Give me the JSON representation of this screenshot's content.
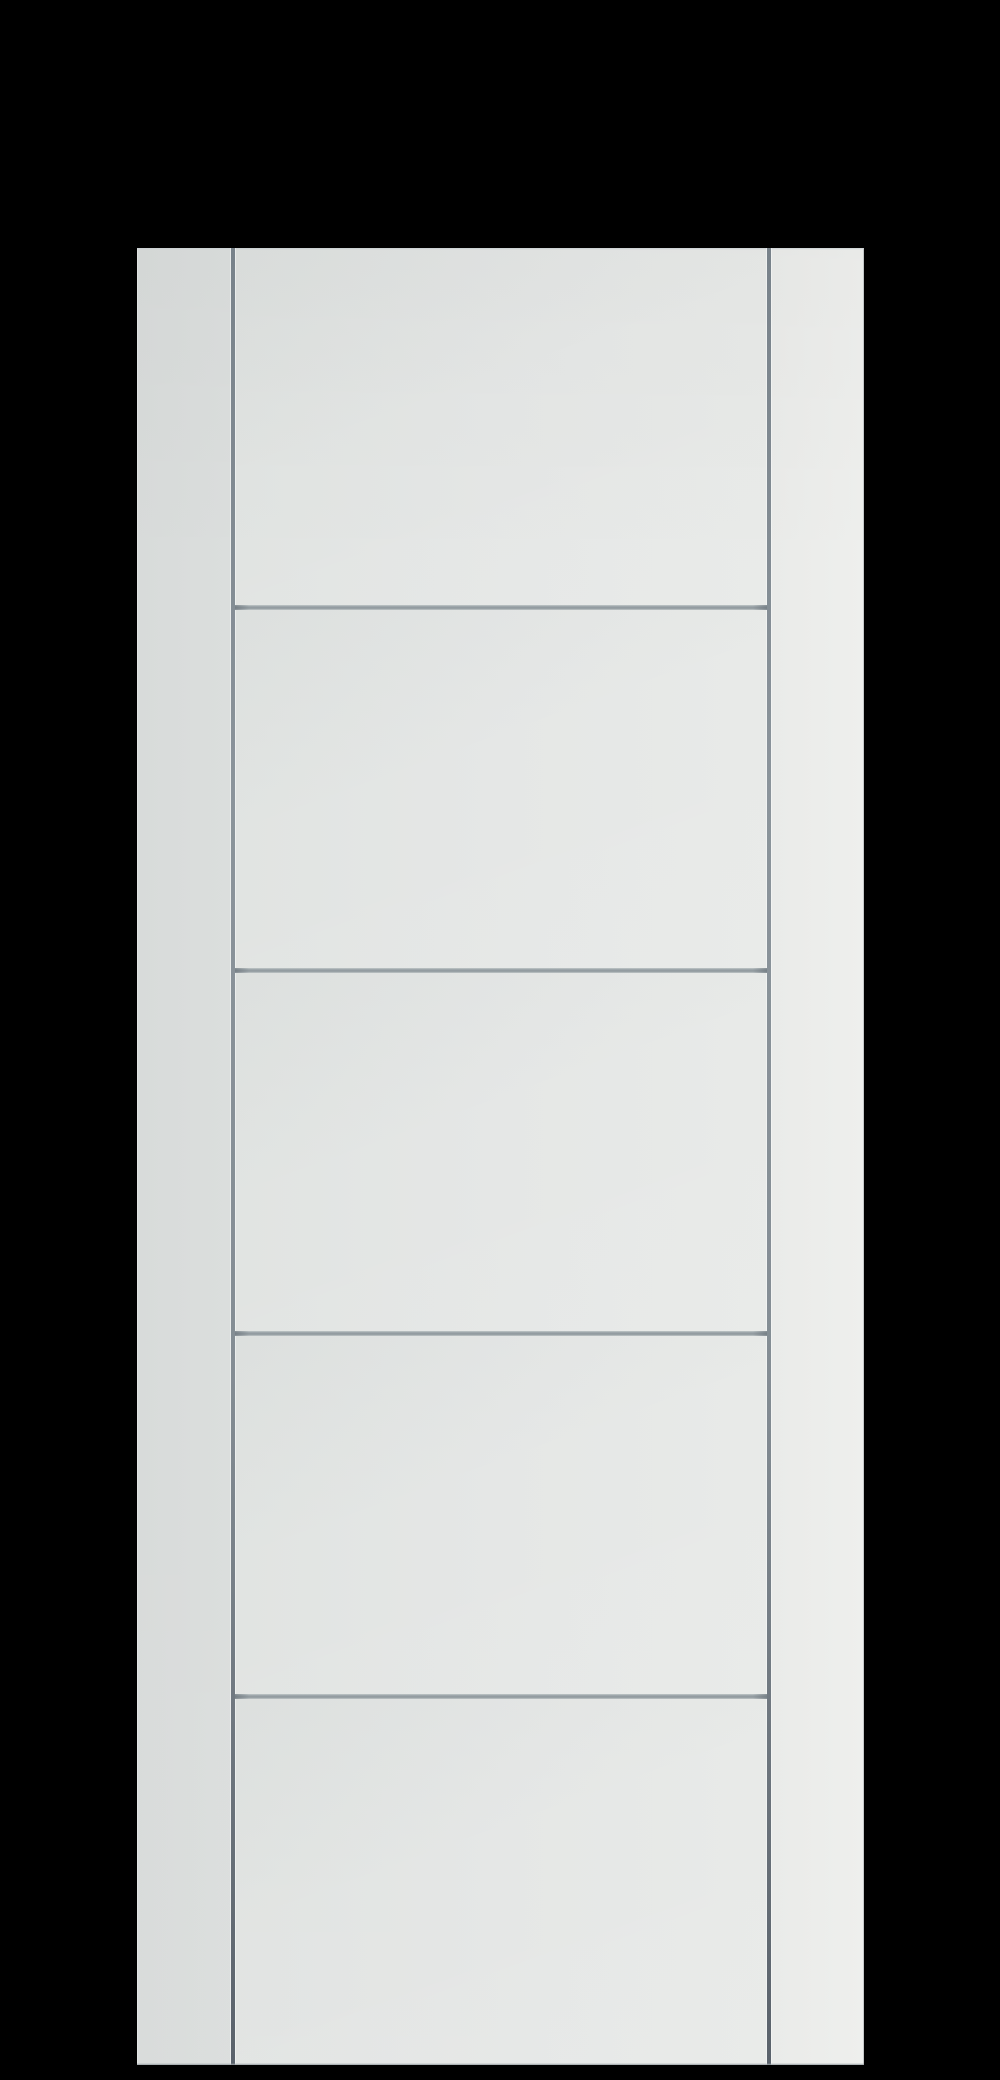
{
  "scene": {
    "subject": "white-five-panel-ladder-door-slab",
    "background_color": "#000000"
  },
  "door": {
    "left": 137,
    "top": 248,
    "width": 727,
    "height": 1817,
    "panel_count": 5,
    "vertical_grooves_x": [
      94,
      630
    ],
    "vertical_groove_width": 4,
    "horizontal_grooves_y": [
      357,
      720,
      1083,
      1446
    ],
    "horizontal_groove_height": 5
  },
  "palette": {
    "backdrop": "#000000",
    "face_left": "#d8dbda",
    "face_left_2": "#dbdedd",
    "face_mid_l": "#e1e4e2",
    "face_mid": "#e5e7e6",
    "face_mid_r": "#e8eae8",
    "face_right_2": "#eaebe9",
    "face_right": "#eeefed",
    "edge_top_highlight": "#c9cfd2",
    "edge_bottom_shadow": "#9aa1a5",
    "vgroove_top": "#78828a",
    "vgroove_mid": "#8b949b",
    "vgroove_mid_2": "#848d94",
    "vgroove_bottom": "#5a626b",
    "hgroove_light": "#c2c8c9",
    "hgroove_core": "#9aa3a8",
    "hgroove_core_2": "#8e979c",
    "hgroove_light_2": "#c0c6c8"
  }
}
